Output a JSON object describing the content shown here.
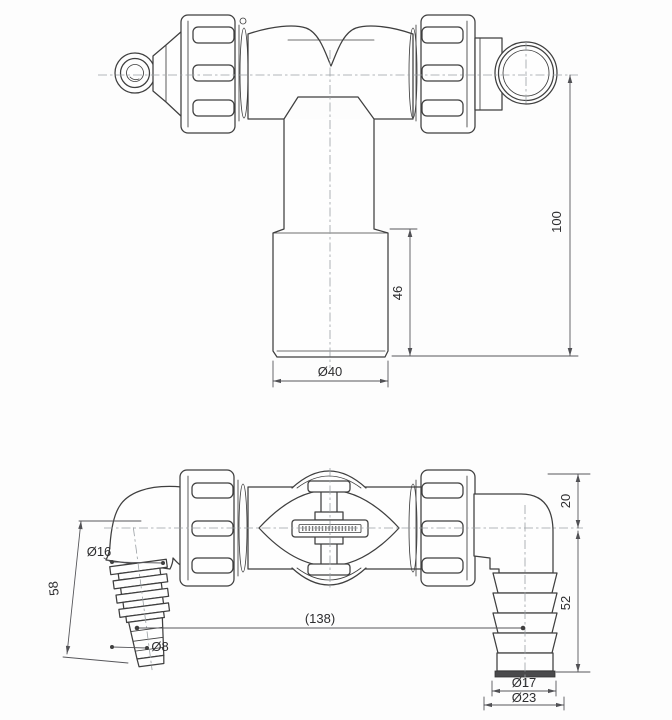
{
  "drawing": {
    "kind": "technical-drawing",
    "subject": "tee siphon fitting with union nuts, hose barb inlet and elbow outlet, two projection views",
    "colors": {
      "background": "#fdfdfd",
      "outline": "#3f3f3f",
      "dimension_line": "#56565a",
      "centerline": "#9aa0a4",
      "text": "#2d2d2f",
      "hose_tip_band": "#4a4a4c"
    },
    "view_top": {
      "dim_overall_height": "100",
      "dim_socket_height": "46",
      "dim_socket_diameter": "Ø40"
    },
    "view_bottom": {
      "dim_center_to_top": "20",
      "dim_center_to_outlet_end": "52",
      "dim_connection_distance": "(138)",
      "dim_inlet_barb_large": "Ø16",
      "dim_inlet_barb_small": "Ø8",
      "dim_inlet_length": "58",
      "dim_outlet_tip": "Ø17",
      "dim_outlet_flare": "Ø23"
    }
  }
}
